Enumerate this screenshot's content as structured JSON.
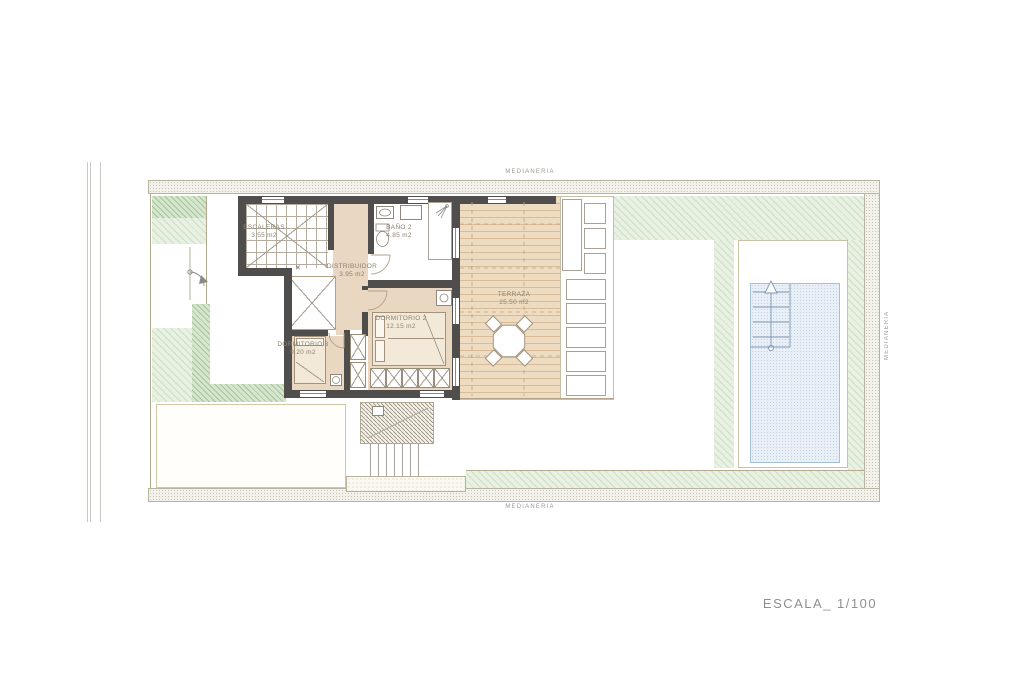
{
  "plan": {
    "scale_label": "ESCALA_ 1/100",
    "boundary_labels": {
      "top": "MEDIANERIA",
      "bottom": "MEDIANERIA",
      "right": "MEDIANERIA"
    },
    "void_marker": "✕",
    "rooms": [
      {
        "name": "ESCALERAS",
        "area": "3.55 m2"
      },
      {
        "name": "BAÑO 2",
        "area": "4.85 m2"
      },
      {
        "name": "DISTRIBUIDOR",
        "area": "3.95 m2"
      },
      {
        "name": "DORMITORIO 2",
        "area": "12.15 m2"
      },
      {
        "name": "DORMITORIO 3",
        "area": "9.20 m2"
      },
      {
        "name": "TERRAZA",
        "area": "25.50 m2"
      }
    ],
    "colors": {
      "wall": "#4f4e4c",
      "floor": "#e9d7c1",
      "deck": "#eedcc2",
      "deck_plank": "#d8bc98",
      "garden_green": "#cfe3c6",
      "pool_water": "#e9eff7",
      "pool_edge": "#a8bfd8",
      "room_label": "#8b8272",
      "boundary_text": "#9a9a93",
      "scale_text": "#8f8f8f"
    }
  }
}
